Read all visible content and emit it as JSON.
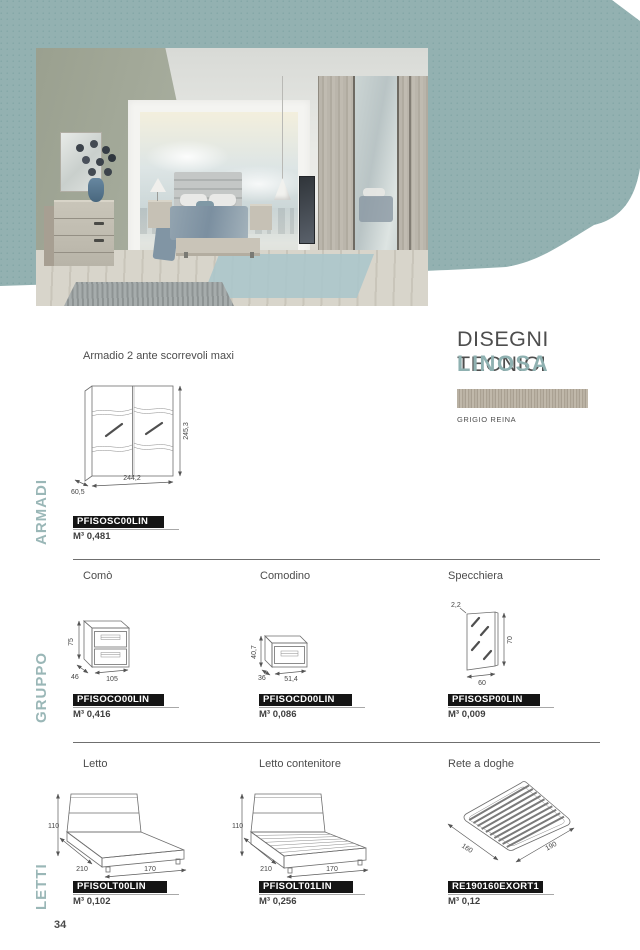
{
  "page_number": "34",
  "header": {
    "title": "DISEGNI TECNICI",
    "collection": "LINOSA",
    "finish": "GRIGIO REINA"
  },
  "colors": {
    "accent_teal": "#8fb1b1",
    "blob_teal": "#93b1b1",
    "badge_black": "#151515",
    "text_grey": "#4e4e4e",
    "divider_grey": "#6f6f6f"
  },
  "sections": {
    "armadi": {
      "label": "ARMADI",
      "products": {
        "armadio": {
          "title": "Armadio 2 ante scorrevoli maxi",
          "code": "PFISOSC00LIN",
          "volume": "M³ 0,481",
          "dims": {
            "height": "245,3",
            "width": "244,2",
            "depth": "60,5"
          }
        }
      }
    },
    "gruppo": {
      "label": "GRUPPO",
      "products": {
        "como": {
          "title": "Comò",
          "code": "PFISOCO00LIN",
          "volume": "M³ 0,416",
          "dims": {
            "height": "75",
            "depth": "46",
            "width": "105"
          }
        },
        "comodino": {
          "title": "Comodino",
          "code": "PFISOCD00LIN",
          "volume": "M³ 0,086",
          "dims": {
            "height": "40,7",
            "depth": "36",
            "width": "51,4"
          }
        },
        "specchiera": {
          "title": "Specchiera",
          "code": "PFISOSP00LIN",
          "volume": "M³ 0,009",
          "dims": {
            "thickness": "2,2",
            "height": "70",
            "width": "60"
          }
        }
      }
    },
    "letti": {
      "label": "LETTI",
      "products": {
        "letto": {
          "title": "Letto",
          "code": "PFISOLT00LIN",
          "volume": "M³ 0,102",
          "dims": {
            "height": "110",
            "length": "210",
            "width": "170"
          }
        },
        "letto_contenitore": {
          "title": "Letto contenitore",
          "code": "PFISOLT01LIN",
          "volume": "M³ 0,256",
          "dims": {
            "height": "110",
            "length": "210",
            "width": "170"
          }
        },
        "rete": {
          "title": "Rete a doghe",
          "code": "RE190160EXORT1",
          "volume": "M³ 0,12",
          "dims": {
            "width": "160",
            "length": "190"
          }
        }
      }
    }
  }
}
